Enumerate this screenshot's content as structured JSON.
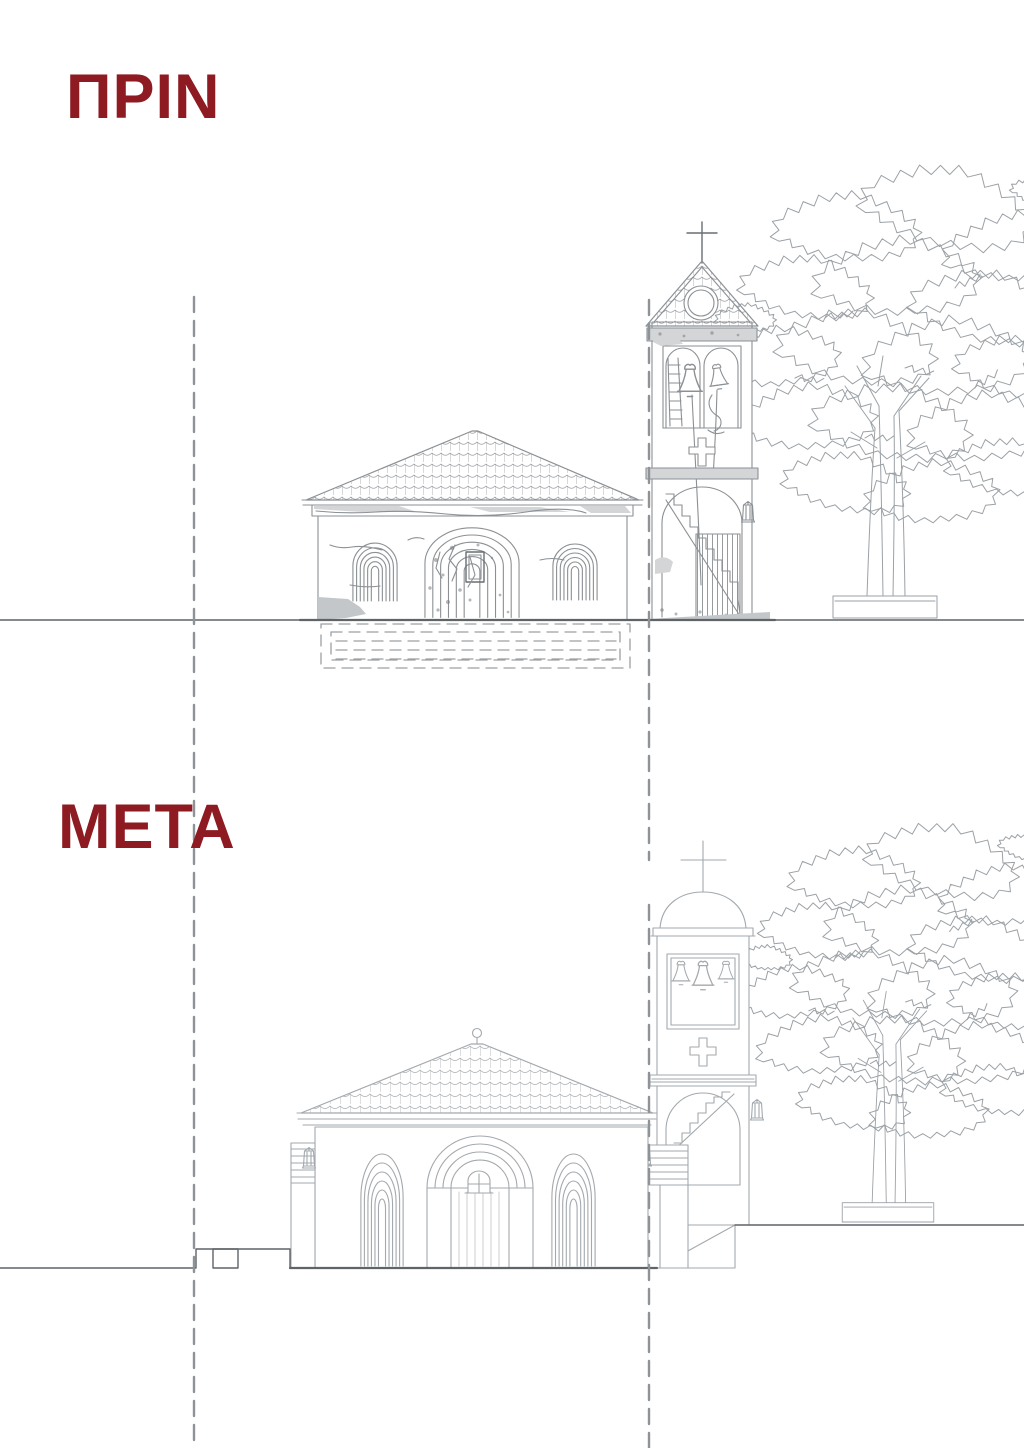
{
  "page": {
    "background": "#ffffff"
  },
  "theme": {
    "accent": "#8e1b21",
    "ink_before": "#8b9094",
    "ink_after": "#a3a9ae",
    "ink_tree": "#9ba1a6",
    "ground": "#5f6468",
    "dash": "#8f9397"
  },
  "sections": {
    "before": {
      "label": "ΠΡΙΝ"
    },
    "after": {
      "label": "ΜΕΤΑ"
    }
  }
}
